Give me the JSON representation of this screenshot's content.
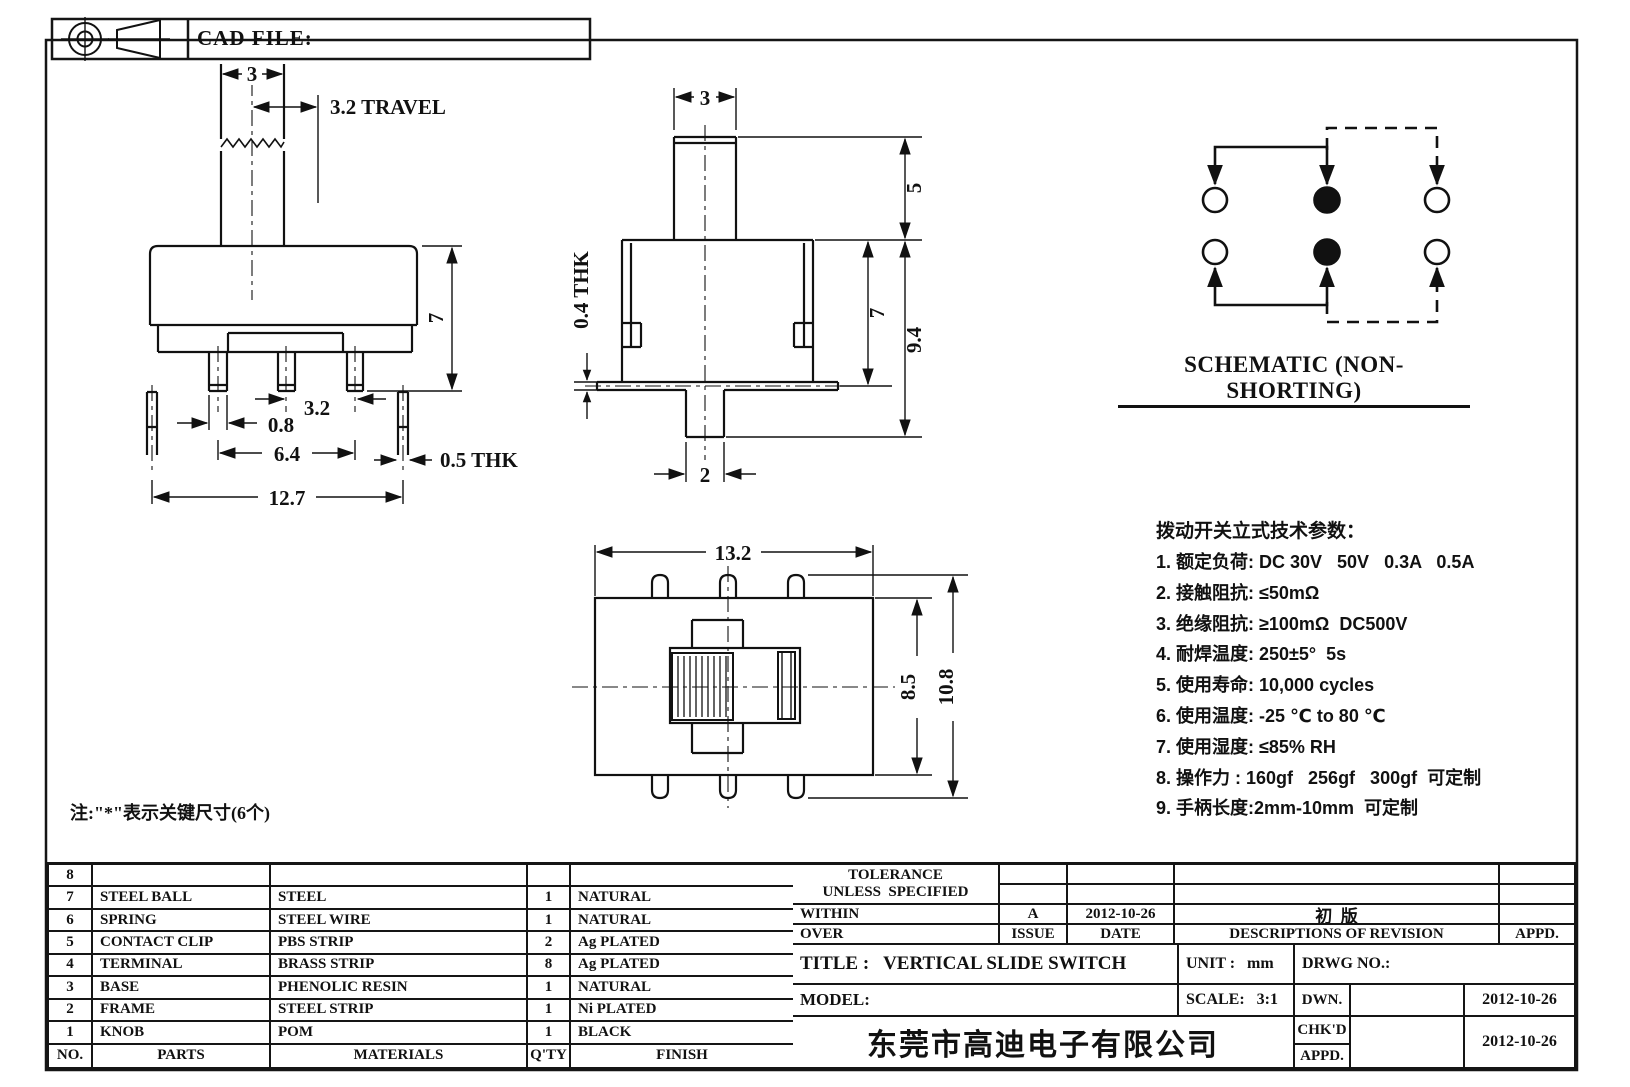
{
  "header": {
    "cad_file_label": "CAD FILE:"
  },
  "front_view": {
    "knob_width": "3",
    "travel": "3.2 TRAVEL",
    "body_height": "7",
    "pin_pitch": "3.2",
    "pin_width": "0.8",
    "pitch_span": "6.4",
    "total_width": "12.7",
    "terminal_thk": "0.5 THK"
  },
  "side_view": {
    "knob_width": "3",
    "knob_height": "5",
    "body_height": "7",
    "total_height": "9.4",
    "pin_width": "2",
    "flange_thk": "0.4 THK"
  },
  "top_view": {
    "width": "13.2",
    "body_depth": "8.5",
    "total_depth": "10.8"
  },
  "schematic": {
    "title": "SCHEMATIC (NON-SHORTING)"
  },
  "tech_params": {
    "title": "拨动开关立式技术参数：",
    "items": [
      "1. 额定负荷: DC 30V   50V   0.3A   0.5A",
      "2. 接触阻抗: ≤50mΩ",
      "3. 绝缘阻抗: ≥100mΩ  DC500V",
      "4. 耐焊温度: 250±5°  5s",
      "5. 使用寿命: 10,000 cycles",
      "6. 使用温度: -25 ℃ to 80 ℃",
      "7. 使用湿度: ≤85% RH",
      "8. 操作力 : 160gf   256gf   300gf  可定制",
      "9. 手柄长度:2mm-10mm  可定制"
    ]
  },
  "note": "注:\"*\"表示关键尺寸(6个)",
  "parts_table": {
    "headers": {
      "no": "NO.",
      "parts": "PARTS",
      "materials": "MATERIALS",
      "qty": "Q'TY",
      "finish": "FINISH"
    },
    "rows": [
      {
        "no": "8",
        "parts": "",
        "materials": "",
        "qty": "",
        "finish": ""
      },
      {
        "no": "7",
        "parts": "STEEL BALL",
        "materials": "STEEL",
        "qty": "1",
        "finish": "NATURAL"
      },
      {
        "no": "6",
        "parts": "SPRING",
        "materials": "STEEL WIRE",
        "qty": "1",
        "finish": "NATURAL"
      },
      {
        "no": "5",
        "parts": "CONTACT CLIP",
        "materials": "PBS STRIP",
        "qty": "2",
        "finish": "Ag PLATED"
      },
      {
        "no": "4",
        "parts": "TERMINAL",
        "materials": "BRASS STRIP",
        "qty": "8",
        "finish": "Ag PLATED"
      },
      {
        "no": "3",
        "parts": "BASE",
        "materials": "PHENOLIC RESIN",
        "qty": "1",
        "finish": "NATURAL"
      },
      {
        "no": "2",
        "parts": "FRAME",
        "materials": "STEEL STRIP",
        "qty": "1",
        "finish": "Ni PLATED"
      },
      {
        "no": "1",
        "parts": "KNOB",
        "materials": "POM",
        "qty": "1",
        "finish": "BLACK"
      }
    ]
  },
  "title_block": {
    "tolerance_1": "TOLERANCE",
    "tolerance_2": "UNLESS  SPECIFIED",
    "within": "WITHIN",
    "over": "OVER",
    "issue_value": "A",
    "issue_label": "ISSUE",
    "date_value": "2012-10-26",
    "date_label": "DATE",
    "revision": "初  版",
    "descriptions_label": "DESCRIPTIONS OF REVISION",
    "appd_col_label": "APPD.",
    "title": "TITLE :   VERTICAL SLIDE SWITCH",
    "unit": "UNIT :   mm",
    "drwg": "DRWG NO.:",
    "model": "MODEL:",
    "scale": "SCALE:   3:1",
    "dwn_label": "DWN.",
    "chkd_label": "CHK'D",
    "appd_label": "APPD.",
    "dwn_date": "2012-10-26",
    "chkd_date": "2012-10-26",
    "company": "东莞市高迪电子有限公司"
  }
}
